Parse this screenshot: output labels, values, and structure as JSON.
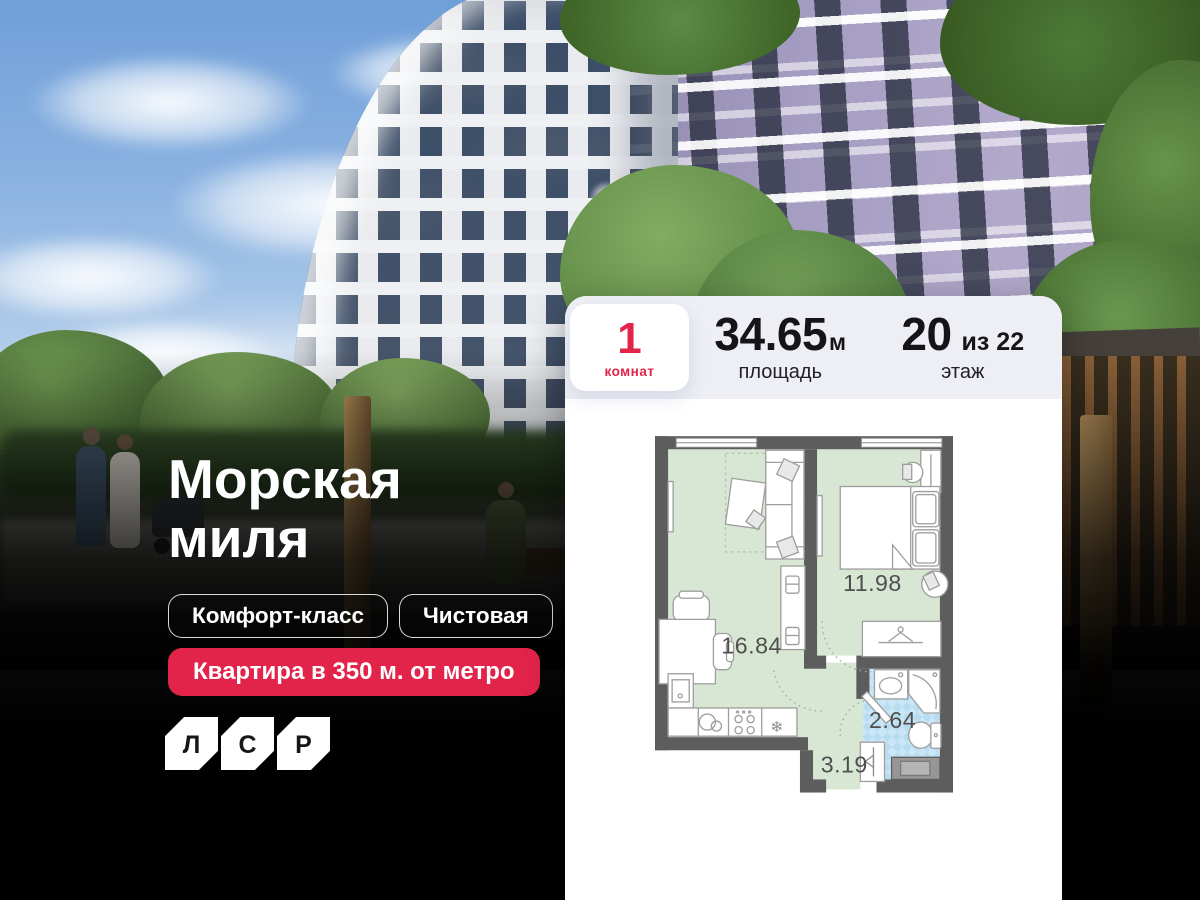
{
  "hero": {
    "title": {
      "line1": "Морская",
      "line2": "миля"
    },
    "tags": [
      {
        "label": "Комфорт-класс"
      },
      {
        "label": "Чистовая"
      }
    ],
    "badge": {
      "label": "Квартира в 350 м. от метро"
    },
    "logo": {
      "letters": [
        "Л",
        "С",
        "Р"
      ]
    }
  },
  "card": {
    "rooms": {
      "value": "1",
      "label": "комнат"
    },
    "area": {
      "value": "34.65",
      "unit": "м",
      "label": "площадь"
    },
    "floor": {
      "value": "20",
      "suffix": "из 22",
      "label": "этаж"
    }
  },
  "floor_plan": {
    "living_kitchen_area": "16.84",
    "bedroom_area": "11.98",
    "bathroom_area": "2.64",
    "hallway_area": "3.19",
    "fridge_icon": "❄"
  },
  "colors": {
    "accent_red": "#e2234a",
    "card_header_bg": "#edeff4",
    "plan_wall": "#5d5d5d",
    "plan_room_fill": "#d8e7d4",
    "plan_bathroom_fill": "#b9ddf0"
  }
}
